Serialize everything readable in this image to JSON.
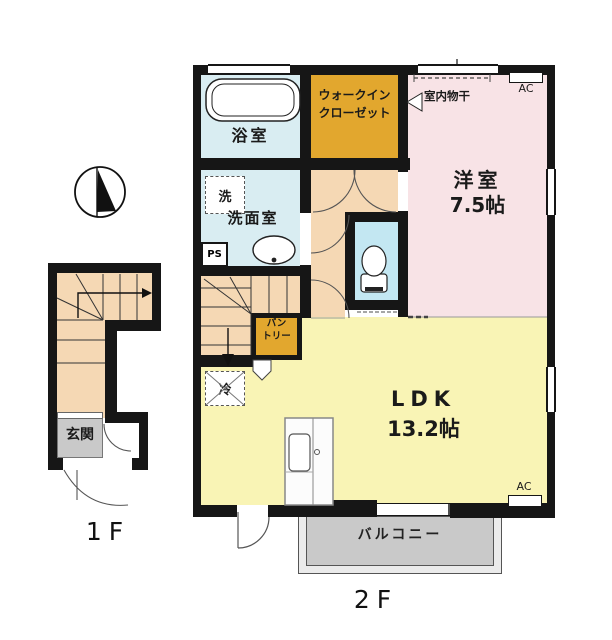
{
  "title": "apartment-floor-plan",
  "colors": {
    "wall": "#161616",
    "bath_cyan": "#d9edf2",
    "toilet_blue": "#c3e7f2",
    "closet_orange": "#e2a72e",
    "bedroom_pink": "#f8e3e6",
    "ldk_yellow": "#f9f4b5",
    "hall_peach": "#f5d8b4",
    "entrance_gray": "#c9c9c9",
    "balcony_inner_gray": "#c7c7c7",
    "balcony_outer_gray": "#ebebeb"
  },
  "floor1": {
    "floor_label": "1F",
    "entrance_label": "玄関"
  },
  "floor2": {
    "floor_label": "2F",
    "bathroom_label": "浴室",
    "wic_label_line1": "ウォークイン",
    "wic_label_line2": "クローゼット",
    "laundry_label": "洗",
    "washroom_label": "洗面室",
    "pipe_space_label": "PS",
    "indoor_drying_label": "室内物干",
    "ac_label": "AC",
    "western_room_label": "洋室",
    "western_room_size": "7.5帖",
    "pantry_label_line1": "パン",
    "pantry_label_line2": "トリー",
    "refrigerator_label": "冷",
    "ldk_label": "LDK",
    "ldk_size": "13.2帖",
    "balcony_label": "バルコニー"
  }
}
